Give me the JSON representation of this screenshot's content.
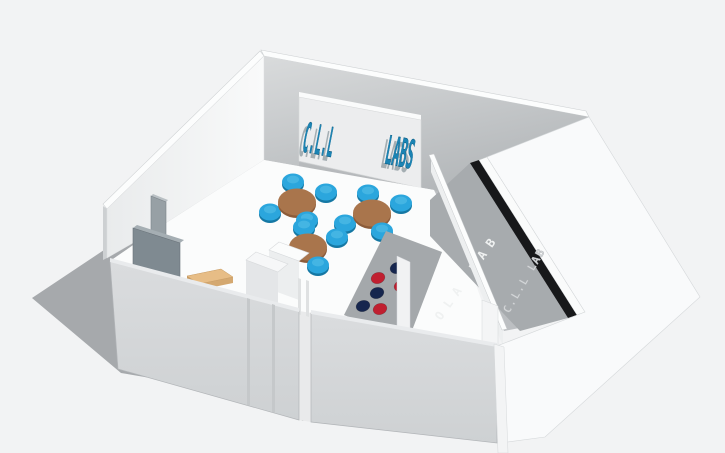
{
  "viewport": {
    "width": 725,
    "height": 453,
    "background": "#f2f3f4",
    "shadow_color": "#a6a9ac"
  },
  "room": {
    "wall_white": "#f7f8f9",
    "wall_top_edge": "#fcfdfd",
    "wall_end_cap": "#cdd0d2",
    "front_wall": "#d6d8da",
    "front_wall_top": "#e9ebed",
    "floor": "#fbfcfc",
    "corridor_floor": "#bcbfc2",
    "inner_gray_wall": "#a7abae",
    "dots_wall_surface": "#a4a8ab",
    "black_strip": "#17181a",
    "partition_face": "#edeff0",
    "gap_fill": "#e9eaeb",
    "right_wall_outer": "#f9fafb"
  },
  "board": {
    "panel": "#ecedee",
    "panel_top": "#fafbfb",
    "left_text": "C.L.L",
    "right_text": "LABS",
    "text_color": "#1b84b4",
    "text_shadow_color": "#5f7078"
  },
  "signs": {
    "exterior_wall_text": "C.L.L LAB",
    "exterior_text_color": "#d4d7d9",
    "interior_wall_text": "OLA LAB",
    "interior_text_color": "#eff1f1"
  },
  "furniture": {
    "table_top": "#a9754c",
    "table_rim": "#8c5c3a",
    "table_rx": 19,
    "table_ry": 13.5,
    "tables": [
      {
        "cx": 297,
        "cy": 202
      },
      {
        "cx": 372,
        "cy": 213
      },
      {
        "cx": 308,
        "cy": 247
      }
    ],
    "stool_main": "#2ba6dd",
    "stool_shade": "#1578a4",
    "stool_highlight": "#55bfe8",
    "stool_rx": 11,
    "stool_ry": 8.5,
    "stool_offsets": [
      [
        -4,
        -20,
        false
      ],
      [
        29,
        -10,
        false
      ],
      [
        -27,
        10,
        false
      ],
      [
        10,
        18,
        true
      ]
    ],
    "desk_top": "#e7bd86",
    "desk_side": "#c79b62",
    "door_panel_back": "#97a0a5",
    "door_panel_back_top": "#b9c0c4",
    "door_panel_front": "#7f8a91",
    "door_panel_front_top": "#a5aeb3",
    "counter_top": "#fbfcfc",
    "counter_face": "#eceeef",
    "counter2_top": "#f6f7f8",
    "counter2_face": "#e4e6e8"
  },
  "dots_wall": {
    "colors": {
      "red": "#c01f30",
      "navy": "#16264e"
    },
    "dots": [
      {
        "x": 397,
        "y": 268,
        "color": "navy"
      },
      {
        "x": 378,
        "y": 278,
        "color": "red"
      },
      {
        "x": 401,
        "y": 286,
        "color": "red"
      },
      {
        "x": 377,
        "y": 293,
        "color": "navy"
      },
      {
        "x": 363,
        "y": 306,
        "color": "navy"
      },
      {
        "x": 380,
        "y": 309,
        "color": "red"
      }
    ]
  }
}
